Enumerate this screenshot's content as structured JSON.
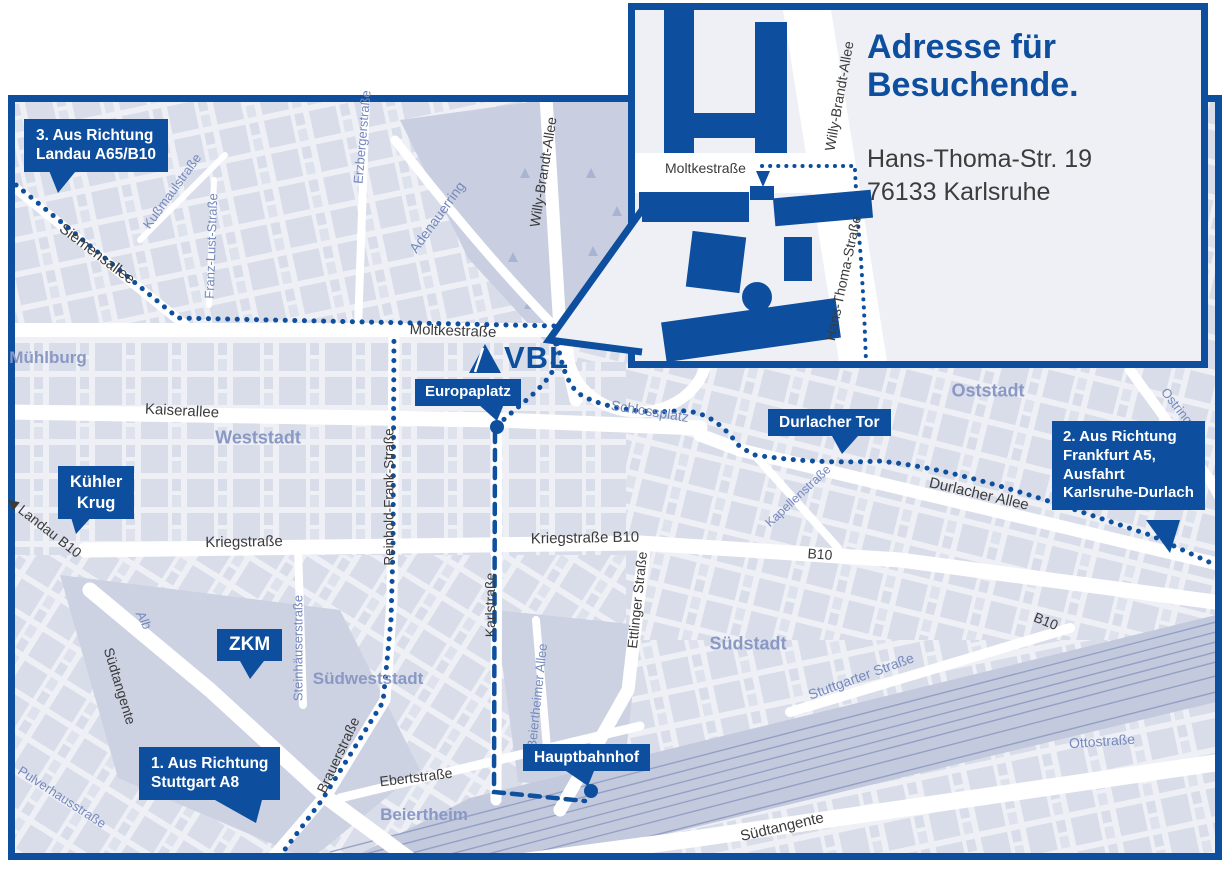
{
  "colors": {
    "brand_blue": "#0d4f9e",
    "map_bg": "#eef0f6",
    "block_fill": "#d8dde9",
    "park_fill": "#c9cfe1",
    "rail_band": "#c3cade",
    "street_label_dark": "#3b3b3b",
    "street_label_blue": "#7689bd",
    "area_label": "#8a98c4"
  },
  "logo": {
    "text": "VBL"
  },
  "inset": {
    "title_line1": "Adresse für",
    "title_line2": "Besuchende.",
    "address_line1": "Hans-Thoma-Str. 19",
    "address_line2": "76133 Karlsruhe",
    "streets": {
      "moltkestrasse": "Moltkestraße",
      "willy_brandt_allee": "Willy-Brandt-Allee",
      "hans_thoma_strasse": "Hans-Thoma-Straße"
    }
  },
  "callouts": {
    "route3": {
      "line1": "3. Aus Richtung",
      "line2": "Landau A65/B10"
    },
    "route1": {
      "line1": "1. Aus Richtung",
      "line2": "Stuttgart A8"
    },
    "route2": {
      "line1": "2. Aus Richtung",
      "line2": "Frankfurt A5,",
      "line3": "Ausfahrt",
      "line4": "Karlsruhe-Durlach"
    },
    "kuehler_krug": {
      "line1": "Kühler",
      "line2": "Krug"
    },
    "zkm": {
      "label": "ZKM"
    },
    "europaplatz": {
      "label": "Europaplatz"
    },
    "durlacher_tor": {
      "label": "Durlacher Tor"
    },
    "hauptbahnhof": {
      "label": "Hauptbahnhof"
    }
  },
  "street_labels": [
    {
      "text": "Siemensallee",
      "x": 97,
      "y": 254,
      "rot": 37,
      "size": 15,
      "cls": "dark"
    },
    {
      "text": "Moltkestraße",
      "x": 453,
      "y": 331,
      "rot": 2,
      "size": 15,
      "cls": "dark"
    },
    {
      "text": "Kaiserallee",
      "x": 182,
      "y": 411,
      "rot": 3,
      "size": 15,
      "cls": "dark"
    },
    {
      "text": "Kriegstraße",
      "x": 244,
      "y": 542,
      "rot": -1,
      "size": 15,
      "cls": "dark"
    },
    {
      "text": "Kriegstraße B10",
      "x": 585,
      "y": 538,
      "rot": -1,
      "size": 15,
      "cls": "dark"
    },
    {
      "text": "Karlstraße",
      "x": 490,
      "y": 605,
      "rot": -90,
      "size": 14,
      "cls": "dark"
    },
    {
      "text": "Ettlinger Straße",
      "x": 637,
      "y": 600,
      "rot": -84,
      "size": 14,
      "cls": "dark"
    },
    {
      "text": "Durlacher Allee",
      "x": 979,
      "y": 494,
      "rot": 13,
      "size": 15,
      "cls": "dark"
    },
    {
      "text": "B10",
      "x": 820,
      "y": 554,
      "rot": 4,
      "size": 14,
      "cls": "dark"
    },
    {
      "text": "B10",
      "x": 1046,
      "y": 621,
      "rot": 22,
      "size": 14,
      "cls": "dark"
    },
    {
      "text": "◀ Landau B10",
      "x": 44,
      "y": 527,
      "rot": 38,
      "size": 14,
      "cls": "dark"
    },
    {
      "text": "Südtangente",
      "x": 120,
      "y": 686,
      "rot": 73,
      "size": 14,
      "cls": "dark"
    },
    {
      "text": "Südtangente",
      "x": 782,
      "y": 827,
      "rot": -13,
      "size": 15,
      "cls": "dark"
    },
    {
      "text": "Brauerstraße",
      "x": 338,
      "y": 755,
      "rot": -65,
      "size": 14,
      "cls": "dark"
    },
    {
      "text": "Ebertstraße",
      "x": 416,
      "y": 777,
      "rot": -7,
      "size": 14,
      "cls": "dark"
    },
    {
      "text": "Reinhold-Frank-Straße",
      "x": 389,
      "y": 497,
      "rot": -90,
      "size": 13.5,
      "cls": "dark"
    },
    {
      "text": "Willy-Brandt-Allee",
      "x": 543,
      "y": 172,
      "rot": -81,
      "size": 14,
      "cls": "dark"
    },
    {
      "text": "Erzbergerstraße",
      "x": 362,
      "y": 137,
      "rot": -85,
      "size": 13,
      "cls": "blue"
    },
    {
      "text": "Kußmaulstraße",
      "x": 172,
      "y": 191,
      "rot": -54,
      "size": 13,
      "cls": "blue"
    },
    {
      "text": "Franz-Lust-Straße",
      "x": 211,
      "y": 246,
      "rot": -88,
      "size": 13,
      "cls": "blue"
    },
    {
      "text": "Adenauerring",
      "x": 437,
      "y": 217,
      "rot": -54,
      "size": 14,
      "cls": "blue"
    },
    {
      "text": "Schlossplatz",
      "x": 650,
      "y": 411,
      "rot": 9,
      "size": 14,
      "cls": "blue"
    },
    {
      "text": "Kapellenstraße",
      "x": 798,
      "y": 496,
      "rot": -43,
      "size": 12.5,
      "cls": "blue"
    },
    {
      "text": "Ostring",
      "x": 1177,
      "y": 406,
      "rot": 52,
      "size": 13,
      "cls": "blue"
    },
    {
      "text": "Stuttgarter Straße",
      "x": 861,
      "y": 676,
      "rot": -20,
      "size": 14,
      "cls": "blue"
    },
    {
      "text": "Beiertheimer Allee",
      "x": 537,
      "y": 696,
      "rot": -84,
      "size": 13,
      "cls": "blue"
    },
    {
      "text": "Ottostraße",
      "x": 1102,
      "y": 741,
      "rot": -4,
      "size": 14,
      "cls": "blue"
    },
    {
      "text": "Alb",
      "x": 144,
      "y": 620,
      "rot": 62,
      "size": 13,
      "cls": "blue",
      "italic": true
    },
    {
      "text": "Steinhäuserstraße",
      "x": 298,
      "y": 648,
      "rot": -90,
      "size": 13,
      "cls": "blue"
    },
    {
      "text": "Pulverhausstraße",
      "x": 62,
      "y": 797,
      "rot": 33,
      "size": 13,
      "cls": "blue"
    }
  ],
  "area_labels": [
    {
      "text": "Mühlburg",
      "x": 48,
      "y": 358,
      "size": 17
    },
    {
      "text": "Weststadt",
      "x": 258,
      "y": 438,
      "size": 18
    },
    {
      "text": "Oststadt",
      "x": 988,
      "y": 391,
      "size": 18
    },
    {
      "text": "Südstadt",
      "x": 748,
      "y": 644,
      "size": 18
    },
    {
      "text": "Südweststadt",
      "x": 368,
      "y": 679,
      "size": 17
    },
    {
      "text": "Beiertheim",
      "x": 424,
      "y": 815,
      "size": 17
    }
  ]
}
